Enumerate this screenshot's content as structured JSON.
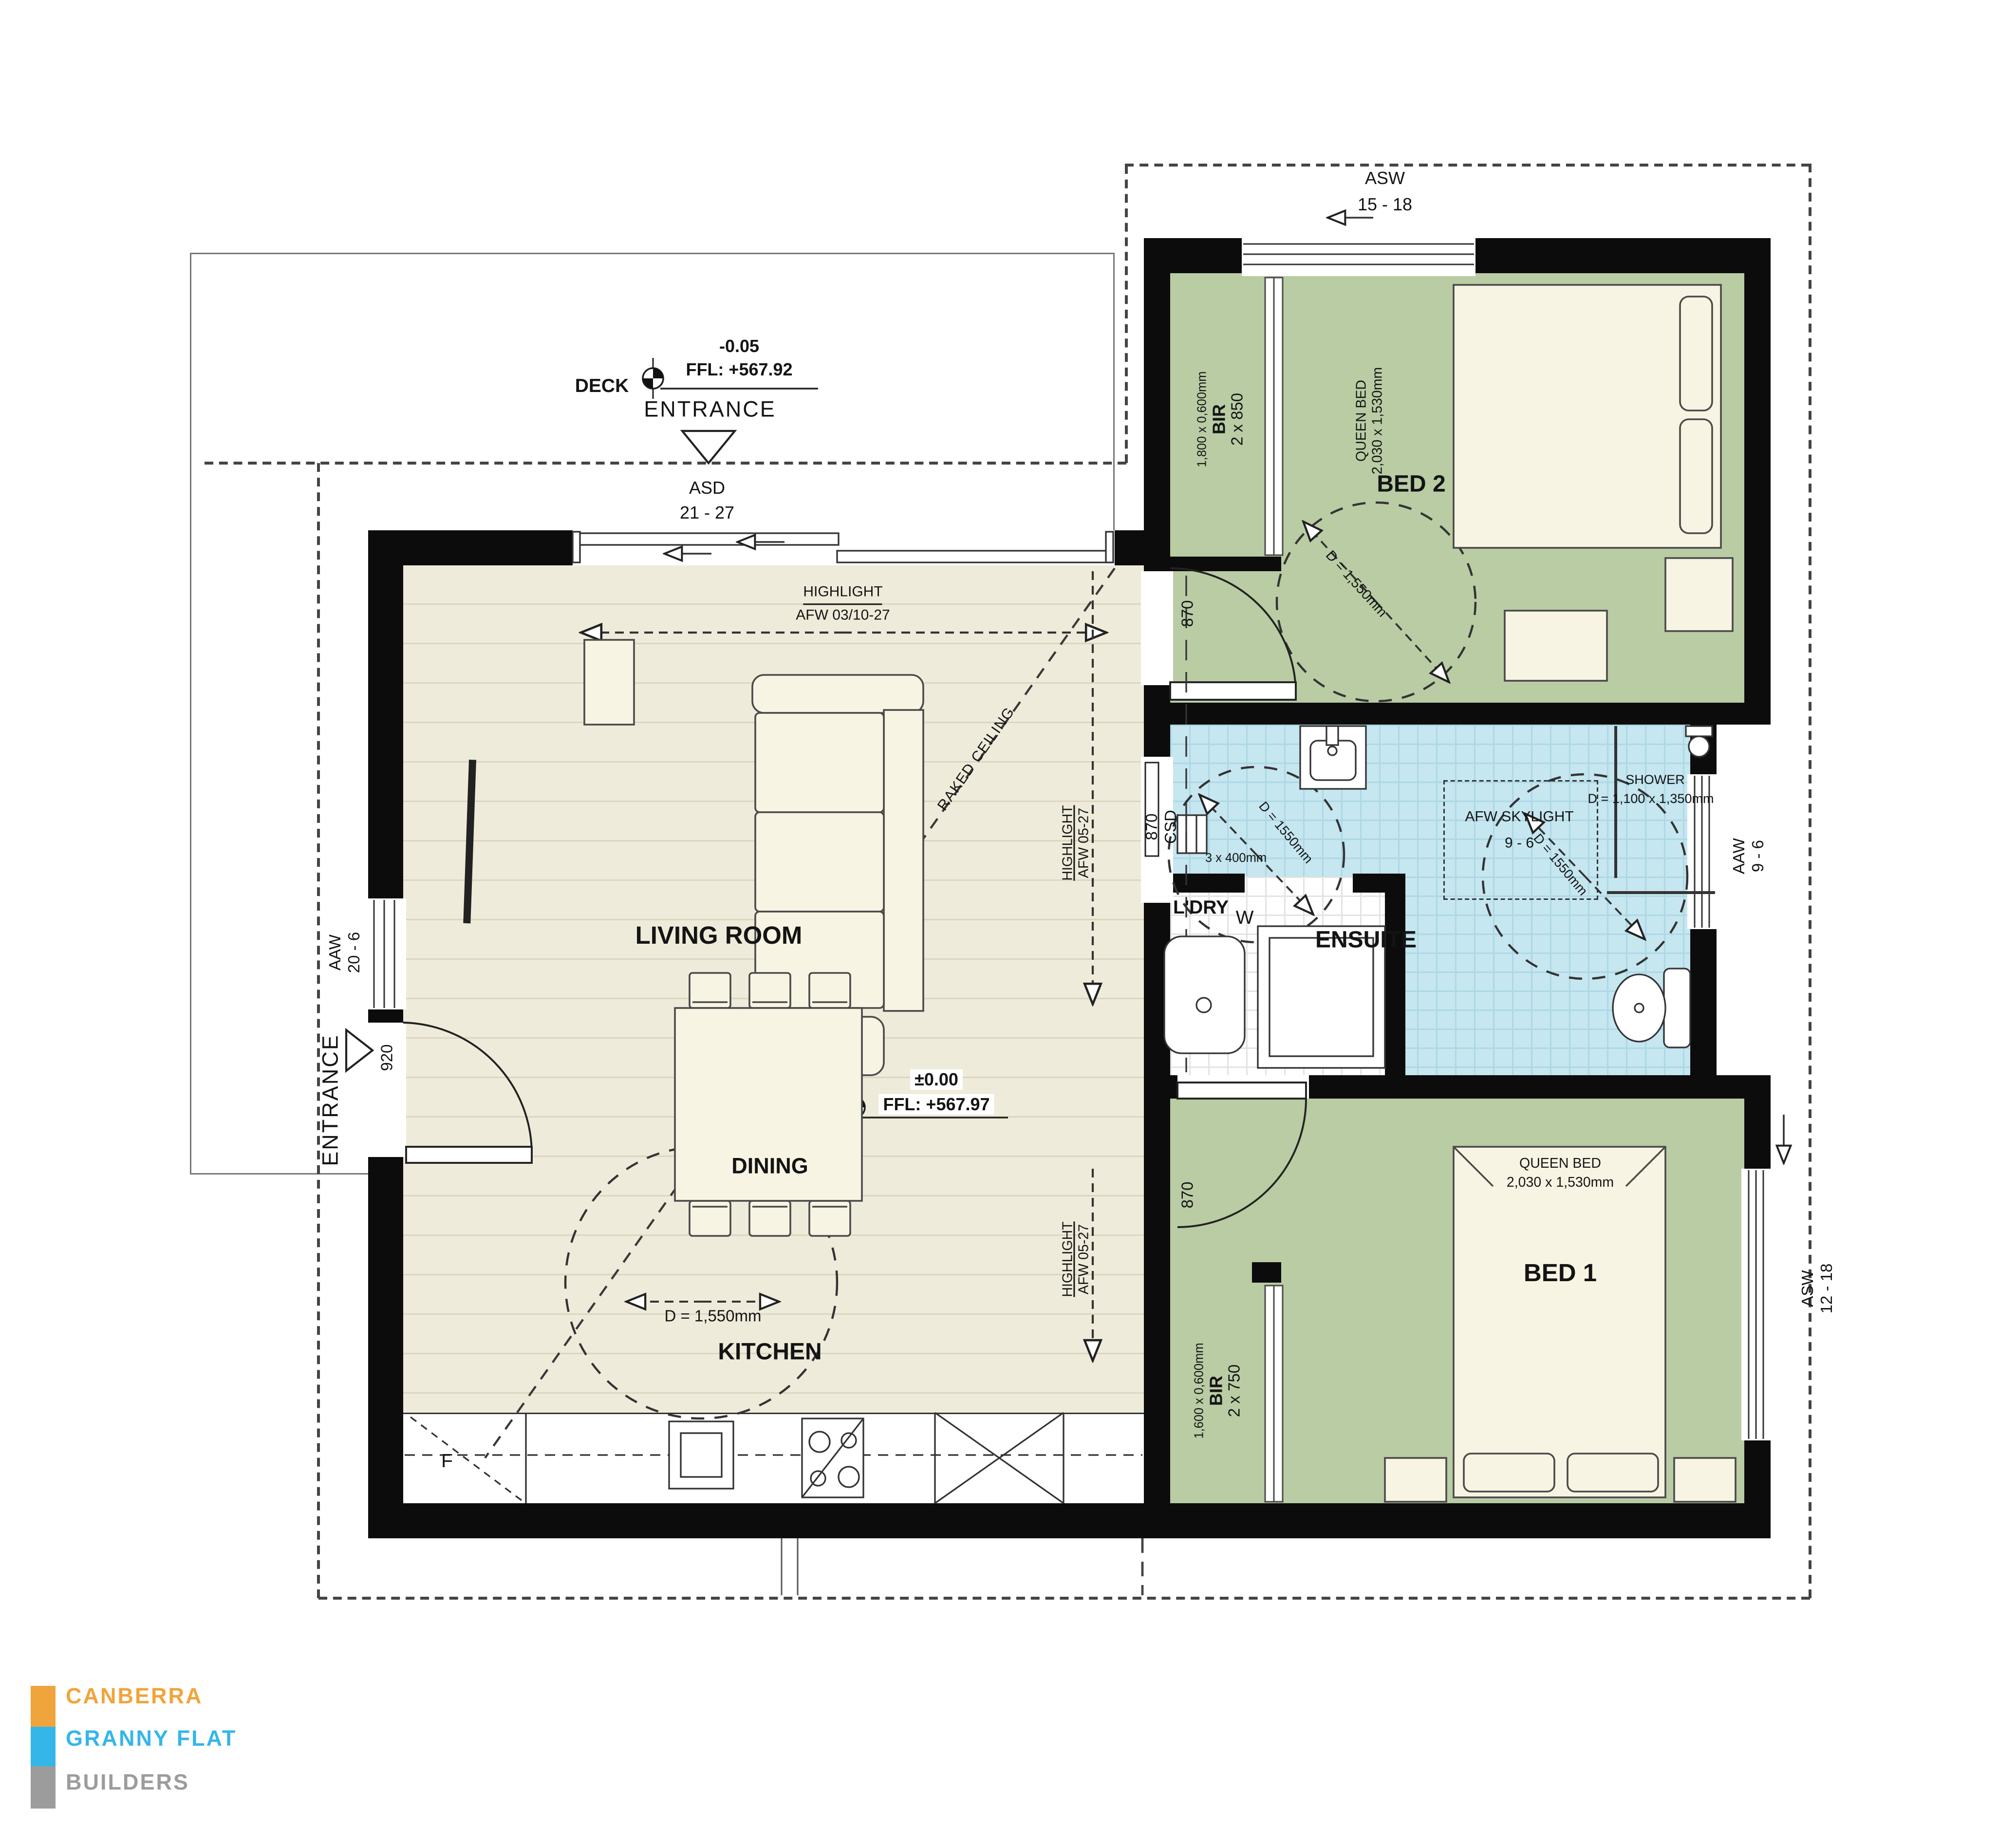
{
  "deck": {
    "label": "DECK",
    "ffl": {
      "level": "-0.05",
      "value": "FFL: +567.92"
    },
    "entrance": "ENTRANCE",
    "door_type": "ASD",
    "door_size": "21 - 27"
  },
  "living": {
    "name": "LIVING ROOM",
    "ffl": {
      "level": "±0.00",
      "value": "FFL: +567.97"
    },
    "hl_top": {
      "l1": "HIGHLIGHT",
      "l2": "AFW 03/10-27"
    },
    "raked": "RAKED CEILING",
    "hl_right": {
      "l1": "HIGHLIGHT",
      "l2": "AFW 05-27"
    }
  },
  "dining": {
    "name": "DINING",
    "turn": "D = 1,550mm"
  },
  "kitchen": {
    "name": "KITCHEN",
    "fridge": "F"
  },
  "west": {
    "entrance": "ENTRANCE",
    "door": "920",
    "win_type": "AAW",
    "win_size": "20 - 6"
  },
  "bed2": {
    "name": "BED 2",
    "bed_l1": "QUEEN BED",
    "bed_l2": "2,030 x 1,530mm",
    "bir_l1": "1,800 x 0,600mm",
    "bir_l2": "BIR",
    "bir_l3": "2 x 850",
    "door": "870",
    "turn": "D = 1,550mm",
    "win_type": "ASW",
    "win_size": "15 - 18"
  },
  "ensuite": {
    "name": "ENSUITE",
    "door_l1": "870",
    "door_l2": "CSD",
    "shelves": "3 x 400mm",
    "sky_l1": "AFW SKYLIGHT",
    "sky_l2": "9 - 6",
    "shower_l1": "SHOWER",
    "shower_l2": "D = 1,100 x 1,350mm",
    "turn_left": "D = 1550mm",
    "turn_right": "D = 1550mm",
    "ldry": "L'DRY",
    "washer": "W",
    "win_type": "AAW",
    "win_size": "9 - 6"
  },
  "bed1": {
    "name": "BED 1",
    "bed_l1": "QUEEN BED",
    "bed_l2": "2,030 x 1,530mm",
    "bir_l1": "1,600 x 0,600mm",
    "bir_l2": "BIR",
    "bir_l3": "2 x 750",
    "door": "870",
    "win_type": "ASW",
    "win_size": "12 - 18"
  },
  "logo": {
    "line1": "CANBERRA",
    "line2": "GRANNY FLAT",
    "line3": "BUILDERS",
    "color1": "#F0A43C",
    "color2": "#35B6E9",
    "color3": "#9C9C9C"
  },
  "colors": {
    "wall": "#0c0c0c",
    "floor_timber": "#EFEBDA",
    "floor_green": "#B9CCA4",
    "floor_blue": "#C6E6F0"
  }
}
